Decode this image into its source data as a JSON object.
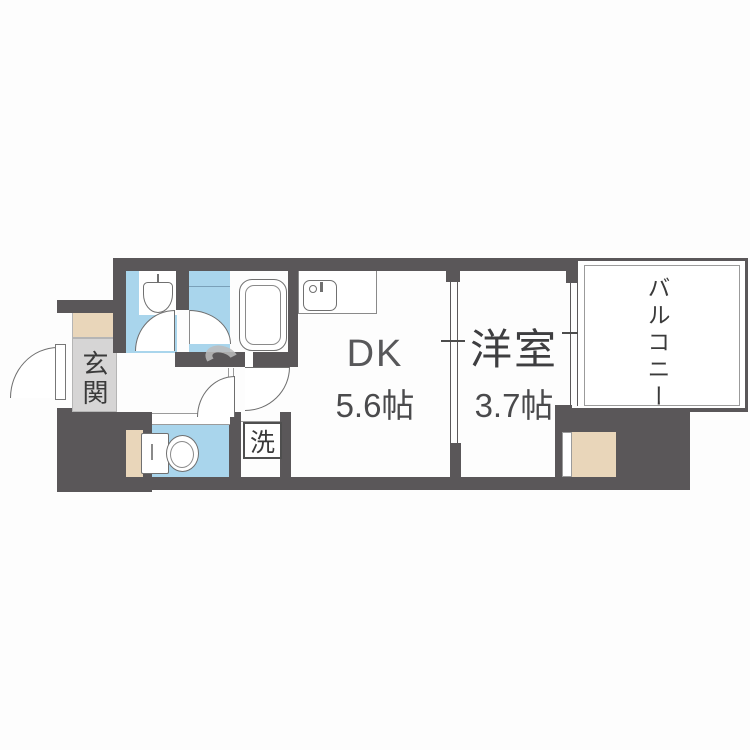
{
  "plan": {
    "rooms": {
      "entrance": {
        "label": "玄関"
      },
      "dining_kitchen": {
        "label": "DK",
        "size": "5.6帖"
      },
      "western_room": {
        "label": "洋室",
        "size": "3.7帖"
      },
      "balcony": {
        "label": "バルコニー"
      },
      "laundry_space": {
        "label": "洗"
      }
    },
    "fixtures": {
      "bathtub": "bathtub",
      "washbasin": "washbasin",
      "toilet": "toilet",
      "kitchen_sink": "kitchen-sink",
      "washing_machine_space": "washing-machine-space",
      "shoe_cabinet": "shoe-cabinet",
      "closet": "closet",
      "entrance_door": "entrance-door"
    },
    "colors": {
      "wall": "#5a5759",
      "wet_area_blue": "#a9d5ec",
      "wood_beige": "#e9d6ba",
      "entrance_tile": "#d6d5d5",
      "background": "#ffffff",
      "fixture_outline": "#707070",
      "label_text": "#3a3a3a",
      "watermark_gray": "#bcbcbc"
    }
  }
}
